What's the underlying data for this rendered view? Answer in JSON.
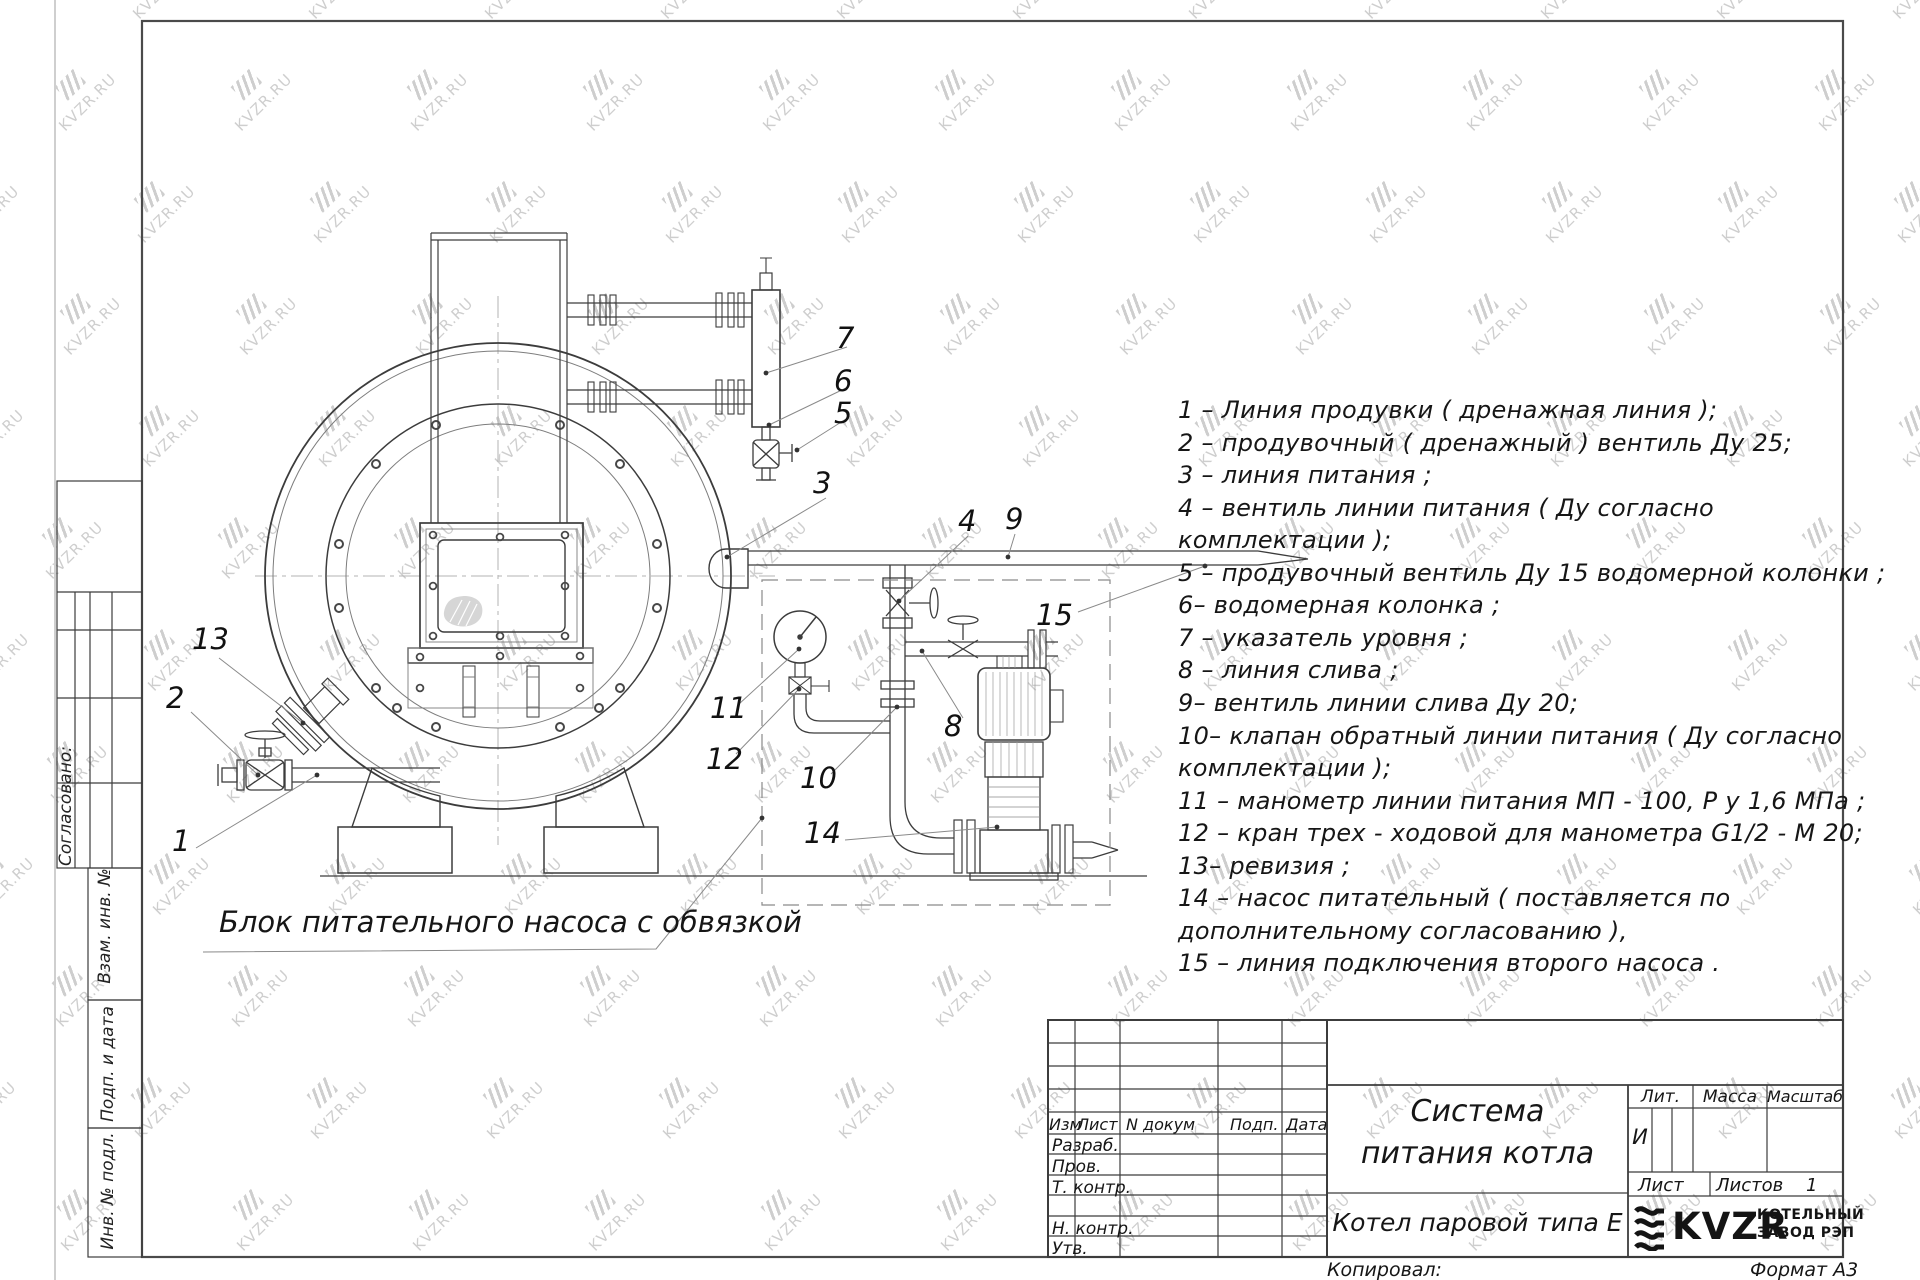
{
  "watermark": {
    "text": "KVZR.RU"
  },
  "caption": "Блок питательного насоса с обвязкой",
  "legend": {
    "lines": [
      "1 –  Линия продувки ( дренажная линия );",
      "2 –  продувочный ( дренажный )  вентиль Ду 25;",
      "3 –  линия питания ;",
      "4 –  вентиль линии питания ( Ду согласно",
      "комплектации );",
      "5 –  продувочный вентиль Ду 15  водомерной колонки ;",
      "6–  водомерная колонка ;",
      "7 –  указатель уровня ;",
      "8 –  линия слива ;",
      "9–  вентиль линии слива Ду 20;",
      "10–  клапан обратный линии питания ( Ду согласно",
      "комплектации );",
      "11 –  манометр линии питания МП - 100, Р у 1,6  МПа ;",
      "12 –  кран трех - ходовой для манометра  G1/2 - М 20;",
      "13–  ревизия ;",
      "14 –  насос питательный ( поставляется по",
      "дополнительному согласованию ),",
      "15 –  линия подключения второго насоса ."
    ]
  },
  "callouts": [
    "1",
    "2",
    "3",
    "4",
    "5",
    "6",
    "7",
    "8",
    "9",
    "10",
    "11",
    "12",
    "13",
    "14",
    "15"
  ],
  "left_margin": {
    "approved": "Согласовано:",
    "vzam": "Взам. инв. №",
    "podp": "Подп. и дата",
    "inv": "Инв. № подл."
  },
  "title_block": {
    "col_izm": "Изм",
    "col_list": "Лист",
    "col_doc": "N докум",
    "col_podp": "Подп.",
    "col_data": "Дата",
    "row_razrab": "Разраб.",
    "row_prov": "Пров.",
    "row_tkontr": "Т. контр.",
    "row_nkontr": "Н. контр.",
    "row_utv": "Утв.",
    "title_line1": "Система",
    "title_line2": "питания котла",
    "product": "Котел паровой типа Е",
    "lit_label": "Лит.",
    "mass_label": "Масса",
    "scale_label": "Масштаб",
    "lit_value": "И",
    "sheet_label": "Лист",
    "sheets_label": "Листов",
    "sheets_value": "1",
    "logo_text": "KVZR",
    "company_line1": "КОТЕЛЬНЫЙ",
    "company_line2": "ЗАВОД РЭП",
    "copied": "Копировал:",
    "format": "Формат А3"
  }
}
